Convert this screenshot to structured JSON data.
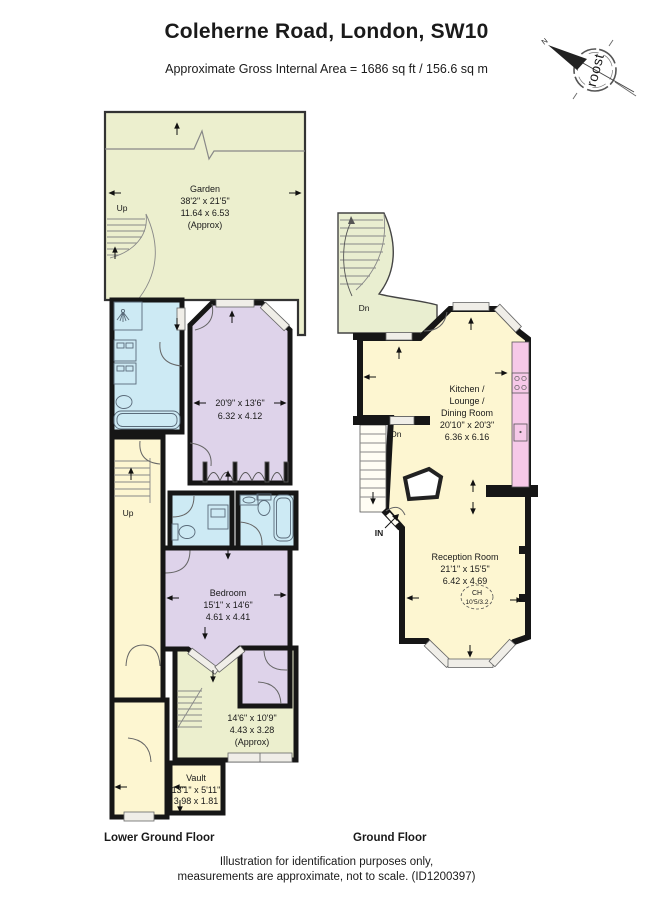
{
  "header": {
    "title": "Coleherne Road, London, SW10",
    "subtitle": "Approximate Gross Internal Area = 1686 sq ft / 156.6 sq m"
  },
  "compass": {
    "brand": "roost",
    "north": "N"
  },
  "lg": {
    "label": "Lower Ground Floor",
    "garden": {
      "name": "Garden",
      "ft": "38'2\" x 21'5\"",
      "m": "11.64 x 6.53",
      "approx": "(Approx)"
    },
    "up_garden": "Up",
    "up_hall": "Up",
    "room1": {
      "ft": "20'9\" x 13'6\"",
      "m": "6.32 x 4.12"
    },
    "bedroom": {
      "name": "Bedroom",
      "ft": "15'1\" x 14'6\"",
      "m": "4.61 x 4.41"
    },
    "rear": {
      "ft": "14'6\" x 10'9\"",
      "m": "4.43 x 3.28",
      "approx": "(Approx)"
    },
    "vault": {
      "name": "Vault",
      "ft": "13'1\" x 5'11\"",
      "m": "3.98 x 1.81"
    }
  },
  "gf": {
    "label": "Ground Floor",
    "dn_garden": "Dn",
    "dn_hall": "Dn",
    "entrance": "IN",
    "kitchen": {
      "l1": "Kitchen /",
      "l2": "Lounge /",
      "l3": "Dining Room",
      "ft": "20'10\" x 20'3\"",
      "m": "6.36 x 6.16"
    },
    "reception": {
      "name": "Reception Room",
      "ft": "21'1\" x 15'5\"",
      "m": "6.42 x 4.69",
      "ch": "CH",
      "chv": "10'5/3.2"
    }
  },
  "footer": {
    "line1": "Illustration for identification purposes only,",
    "line2": "measurements are approximate, not to scale. (ID1200397)"
  },
  "colors": {
    "garden_green": "#ecefce",
    "room_yellow": "#fdf6d1",
    "room_purple": "#ded3ea",
    "bath_blue": "#cdeaf4",
    "counter_pink": "#f6c9e8",
    "wall_black": "#161616"
  }
}
